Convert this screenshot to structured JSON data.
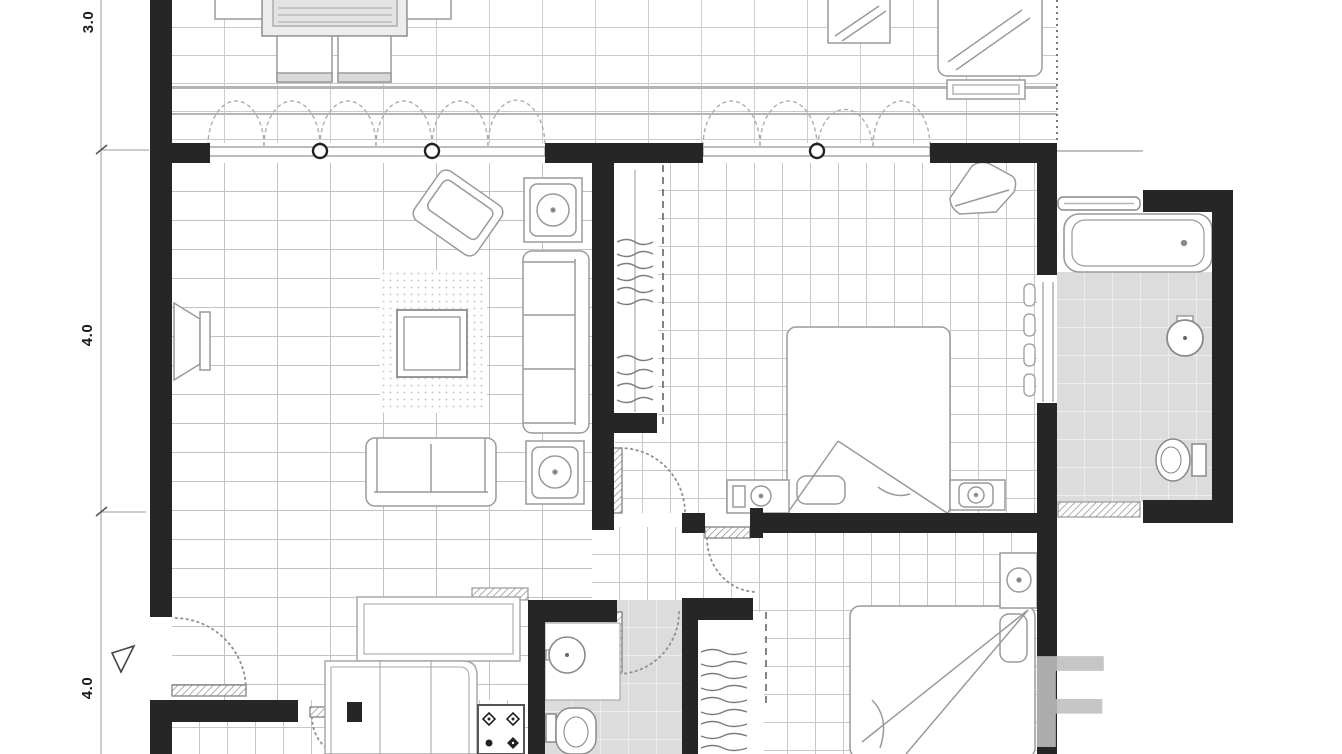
{
  "meta": {
    "kind": "architectural-floor-plan",
    "style": "black-and-white blueprint"
  },
  "dimension_labels": [
    {
      "id": "top",
      "label": "3.0"
    },
    {
      "id": "middle",
      "label": "4.0"
    },
    {
      "id": "bottom",
      "label": "4.0"
    }
  ],
  "watermark": {
    "letter": "F"
  },
  "colors": {
    "wall": "#262626",
    "furniture_line": "#999999",
    "bath_floor": "#dcdcdc",
    "grid_line": "#c6c6c6",
    "dimension_text": "#1b1b1b",
    "watermark": "#bfbfbf"
  },
  "rooms": [
    {
      "name": "balcony"
    },
    {
      "name": "living-room"
    },
    {
      "name": "bedroom-1"
    },
    {
      "name": "bathroom-1"
    },
    {
      "name": "hallway"
    },
    {
      "name": "bedroom-2"
    },
    {
      "name": "bathroom-2"
    },
    {
      "name": "kitchen"
    },
    {
      "name": "closet-1"
    },
    {
      "name": "closet-2"
    }
  ],
  "fixtures": [
    "dining-table",
    "dining-chair",
    "sun-lounger",
    "tv",
    "sofa",
    "loveseat",
    "armchair",
    "coffee-table",
    "rug",
    "side-table-lamp",
    "wardrobe",
    "double-bed",
    "nightstand",
    "bathtub",
    "washbasin",
    "toilet",
    "kitchen-counter",
    "stove",
    "door-swing",
    "casement-window"
  ]
}
